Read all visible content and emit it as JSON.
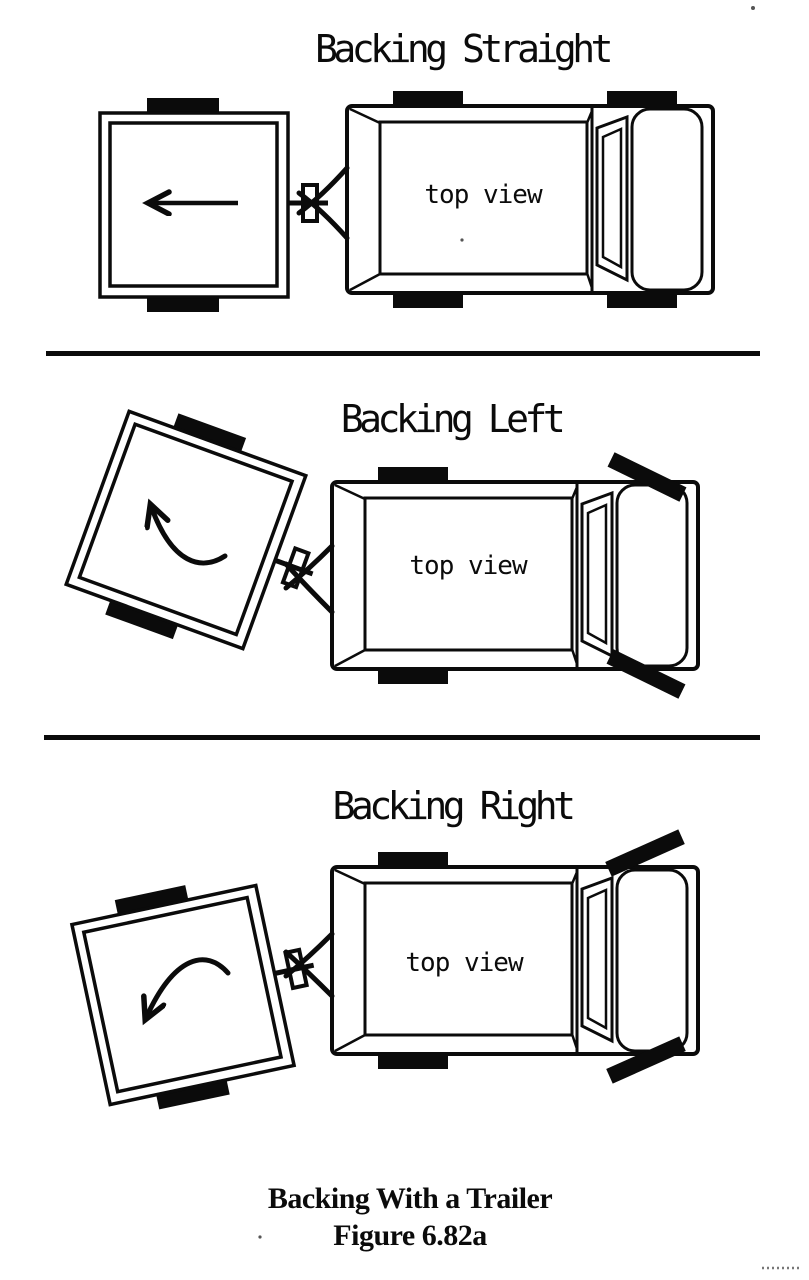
{
  "document": {
    "kind": "scanned manual diagram page",
    "caption": {
      "line1": "Backing With a Trailer",
      "line2": "Figure 6.82a"
    }
  },
  "colors": {
    "ink": "#0b0b0b",
    "paper": "#ffffff"
  },
  "panels": [
    {
      "title": "Backing Straight",
      "truck_label": "top view",
      "trailer_angle_deg": 0,
      "arrow": "straight arrow pointing left (trailer backs straight)",
      "front_wheels": "straight"
    },
    {
      "title": "Backing Left",
      "truck_label": "top view",
      "trailer_angle_deg": 20,
      "arrow": "curved arrow sweeping up-left (trailer swings left)",
      "front_wheels": "turned clockwise"
    },
    {
      "title": "Backing Right",
      "truck_label": "top view",
      "trailer_angle_deg": -12,
      "arrow": "curved arrow sweeping down-left (trailer swings right)",
      "front_wheels": "turned counterclockwise"
    }
  ]
}
